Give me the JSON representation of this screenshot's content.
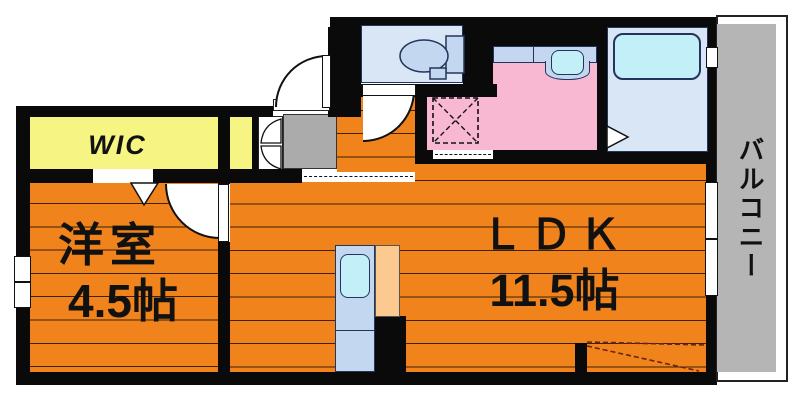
{
  "title": "apartment-floor-plan",
  "rooms": {
    "wic": {
      "label": "WIC"
    },
    "western_room": {
      "label": "洋室",
      "size": "4.5帖"
    },
    "ldk": {
      "label": "ＬＤＫ",
      "size": "11.5帖"
    },
    "balcony": {
      "label": "バルコニー"
    }
  },
  "colors": {
    "floor_orange": "#F0831C",
    "stripe": "#3E2206",
    "closet_yellow": "#F6F584",
    "pink": "#F9B8D2",
    "room_blue": "#D9E6F6",
    "fixture_blue": "#C3D8F0",
    "sink_cyan": "#C2EFF8",
    "entrance_gray": "#ABABAB",
    "balcony_gray": "#B5B5B5",
    "counter_peach": "#FCCA90",
    "wall": "#0A0A0A",
    "outline_navy": "#23355A",
    "dashed_accent": "#6B2410"
  }
}
